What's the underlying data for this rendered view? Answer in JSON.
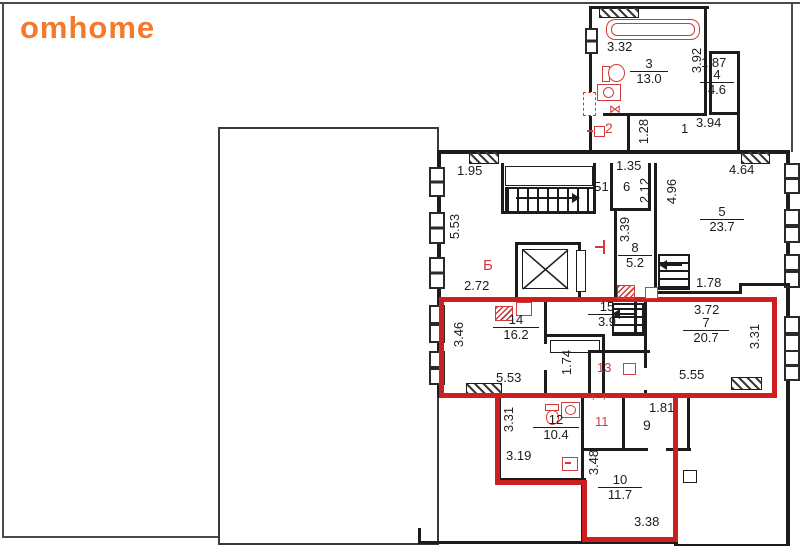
{
  "logo": {
    "text": "omhome",
    "color": "#f4792b"
  },
  "colors": {
    "highlight_outline": "#cc1f1f",
    "room_label_red": "#d33a3a",
    "wall": "#1c1c1c",
    "logo_orange": "#f4792b"
  },
  "rooms": {
    "r1": {
      "num": "1"
    },
    "r2": {
      "num": "2"
    },
    "r3": {
      "num": "3",
      "area": "13.0"
    },
    "r4": {
      "num": "4",
      "area": "4.6"
    },
    "r5": {
      "num": "5",
      "area": "23.7"
    },
    "r6": {
      "num": "6"
    },
    "r7": {
      "num": "7",
      "area": "20.7"
    },
    "r8": {
      "num": "8",
      "area": "5.2"
    },
    "r9": {
      "num": "9"
    },
    "r10": {
      "num": "10",
      "area": "11.7"
    },
    "r11": {
      "num": "11"
    },
    "r12": {
      "num": "12",
      "area": "10.4"
    },
    "r13": {
      "num": "13"
    },
    "r14": {
      "num": "14",
      "area": "16.2"
    },
    "r15": {
      "num": "15",
      "area": "3.9"
    },
    "stair_hall": {
      "num": "Б"
    },
    "stair_upper": {
      "num": "Б1"
    }
  },
  "dims": {
    "d332": "3.32",
    "d392": "3.92",
    "d187": "1.87",
    "d394": "3.94",
    "d128": "1.28",
    "d195": "1.95",
    "d553a": "5.53",
    "d135": "1.35",
    "d212": "2.12",
    "d464": "4.64",
    "d496": "4.96",
    "d339": "3.39",
    "d272": "2.72",
    "d178": "1.78",
    "d372": "3.72",
    "d346": "3.46",
    "d553b": "5.53",
    "d174": "1.74",
    "d331a": "3.31",
    "d555": "5.55",
    "d331b": "3.31",
    "d319": "3.19",
    "d181": "1.81",
    "d348": "3.48",
    "d338": "3.38"
  },
  "marks": {
    "door_cross": "⋈",
    "plus_a": "+",
    "plus_b": "+"
  }
}
